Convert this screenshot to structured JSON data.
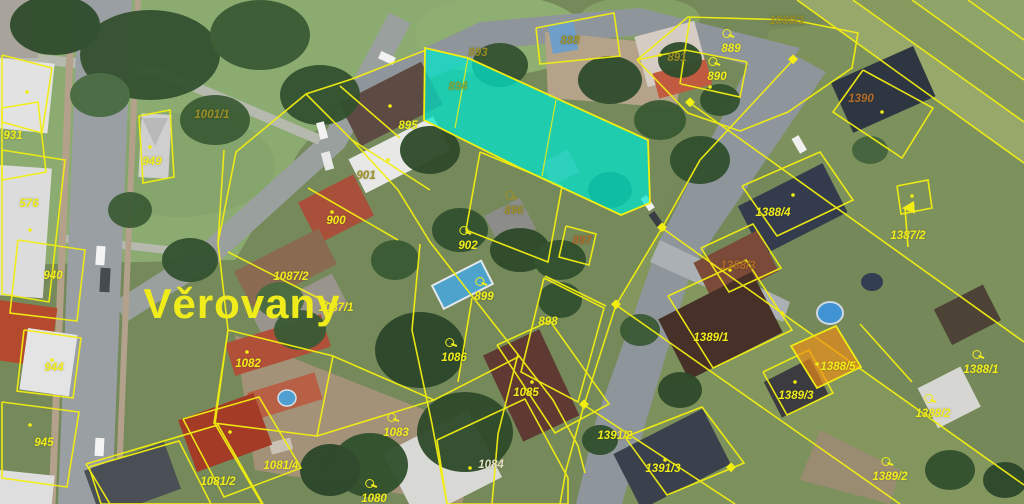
{
  "map": {
    "place_label": "Věrovany",
    "colors": {
      "yellow": "#f0ec1c",
      "olive": "#9a8e26",
      "rust": "#b06a2a",
      "green": "#86a83a",
      "pale": "#e3dfc0",
      "line": "#f2ee12",
      "cyan_fill": "#00e6cf",
      "orange_fill": "#f08c14"
    },
    "highlights": [
      {
        "parcel": "894",
        "style": "cyan"
      },
      {
        "parcel": "1388/5",
        "style": "orange"
      }
    ],
    "labels": [
      {
        "t": "1001/1",
        "x": 212,
        "y": 115,
        "c": "olive"
      },
      {
        "t": "893",
        "x": 478,
        "y": 53,
        "c": "olive"
      },
      {
        "t": "888",
        "x": 570,
        "y": 41,
        "c": "olive"
      },
      {
        "t": "889",
        "x": 731,
        "y": 49,
        "c": "yellow",
        "sym": true
      },
      {
        "t": "891",
        "x": 677,
        "y": 58,
        "c": "olive"
      },
      {
        "t": "890",
        "x": 717,
        "y": 77,
        "c": "yellow",
        "sym": true
      },
      {
        "t": "1060/1",
        "x": 787,
        "y": 21,
        "c": "olive"
      },
      {
        "t": "1390",
        "x": 861,
        "y": 99,
        "c": "rust"
      },
      {
        "t": "894",
        "x": 458,
        "y": 87,
        "c": "green"
      },
      {
        "t": "895",
        "x": 408,
        "y": 126,
        "c": "yellow"
      },
      {
        "t": "901",
        "x": 366,
        "y": 176,
        "c": "olive"
      },
      {
        "t": "900",
        "x": 336,
        "y": 221,
        "c": "yellow"
      },
      {
        "t": "896",
        "x": 514,
        "y": 211,
        "c": "olive",
        "sym": true
      },
      {
        "t": "902",
        "x": 468,
        "y": 246,
        "c": "yellow",
        "sym": true
      },
      {
        "t": "897",
        "x": 582,
        "y": 241,
        "c": "rust"
      },
      {
        "t": "899",
        "x": 484,
        "y": 297,
        "c": "yellow",
        "sym": true
      },
      {
        "t": "898",
        "x": 548,
        "y": 322,
        "c": "yellow"
      },
      {
        "t": "1087/2",
        "x": 291,
        "y": 277,
        "c": "yellow"
      },
      {
        "t": "1087/1",
        "x": 336,
        "y": 308,
        "c": "yellow"
      },
      {
        "t": "931",
        "x": 13,
        "y": 136,
        "c": "yellow"
      },
      {
        "t": "576",
        "x": 29,
        "y": 204,
        "c": "yellow"
      },
      {
        "t": "940",
        "x": 53,
        "y": 276,
        "c": "yellow"
      },
      {
        "t": "944",
        "x": 54,
        "y": 368,
        "c": "yellow"
      },
      {
        "t": "945",
        "x": 44,
        "y": 443,
        "c": "yellow"
      },
      {
        "t": "949",
        "x": 152,
        "y": 162,
        "c": "yellow"
      },
      {
        "t": "1082",
        "x": 248,
        "y": 364,
        "c": "yellow"
      },
      {
        "t": "1081/2",
        "x": 218,
        "y": 482,
        "c": "yellow"
      },
      {
        "t": "1081/4",
        "x": 281,
        "y": 466,
        "c": "yellow"
      },
      {
        "t": "1083",
        "x": 396,
        "y": 433,
        "c": "yellow",
        "sym": true
      },
      {
        "t": "1086",
        "x": 454,
        "y": 358,
        "c": "yellow",
        "sym": true
      },
      {
        "t": "1085",
        "x": 526,
        "y": 393,
        "c": "yellow"
      },
      {
        "t": "1084",
        "x": 491,
        "y": 465,
        "c": "pale"
      },
      {
        "t": "1080",
        "x": 374,
        "y": 499,
        "c": "yellow",
        "sym": true
      },
      {
        "t": "1388/4",
        "x": 773,
        "y": 213,
        "c": "yellow"
      },
      {
        "t": "1387/2",
        "x": 908,
        "y": 236,
        "c": "yellow"
      },
      {
        "t": "1388/3",
        "x": 738,
        "y": 266,
        "c": "rust"
      },
      {
        "t": "1389/1",
        "x": 711,
        "y": 338,
        "c": "yellow"
      },
      {
        "t": "1388/5",
        "x": 838,
        "y": 367,
        "c": "yellow"
      },
      {
        "t": "1389/3",
        "x": 796,
        "y": 396,
        "c": "yellow"
      },
      {
        "t": "1388/1",
        "x": 981,
        "y": 370,
        "c": "yellow",
        "sym": true
      },
      {
        "t": "1388/2",
        "x": 933,
        "y": 414,
        "c": "yellow",
        "sym": true
      },
      {
        "t": "1389/2",
        "x": 890,
        "y": 477,
        "c": "yellow",
        "sym": true
      },
      {
        "t": "1391/2",
        "x": 615,
        "y": 436,
        "c": "yellow"
      },
      {
        "t": "1391/3",
        "x": 663,
        "y": 469,
        "c": "yellow"
      },
      {
        "t": "Věrovany",
        "x": 242,
        "y": 304,
        "c": "yellow",
        "place": true
      }
    ]
  }
}
